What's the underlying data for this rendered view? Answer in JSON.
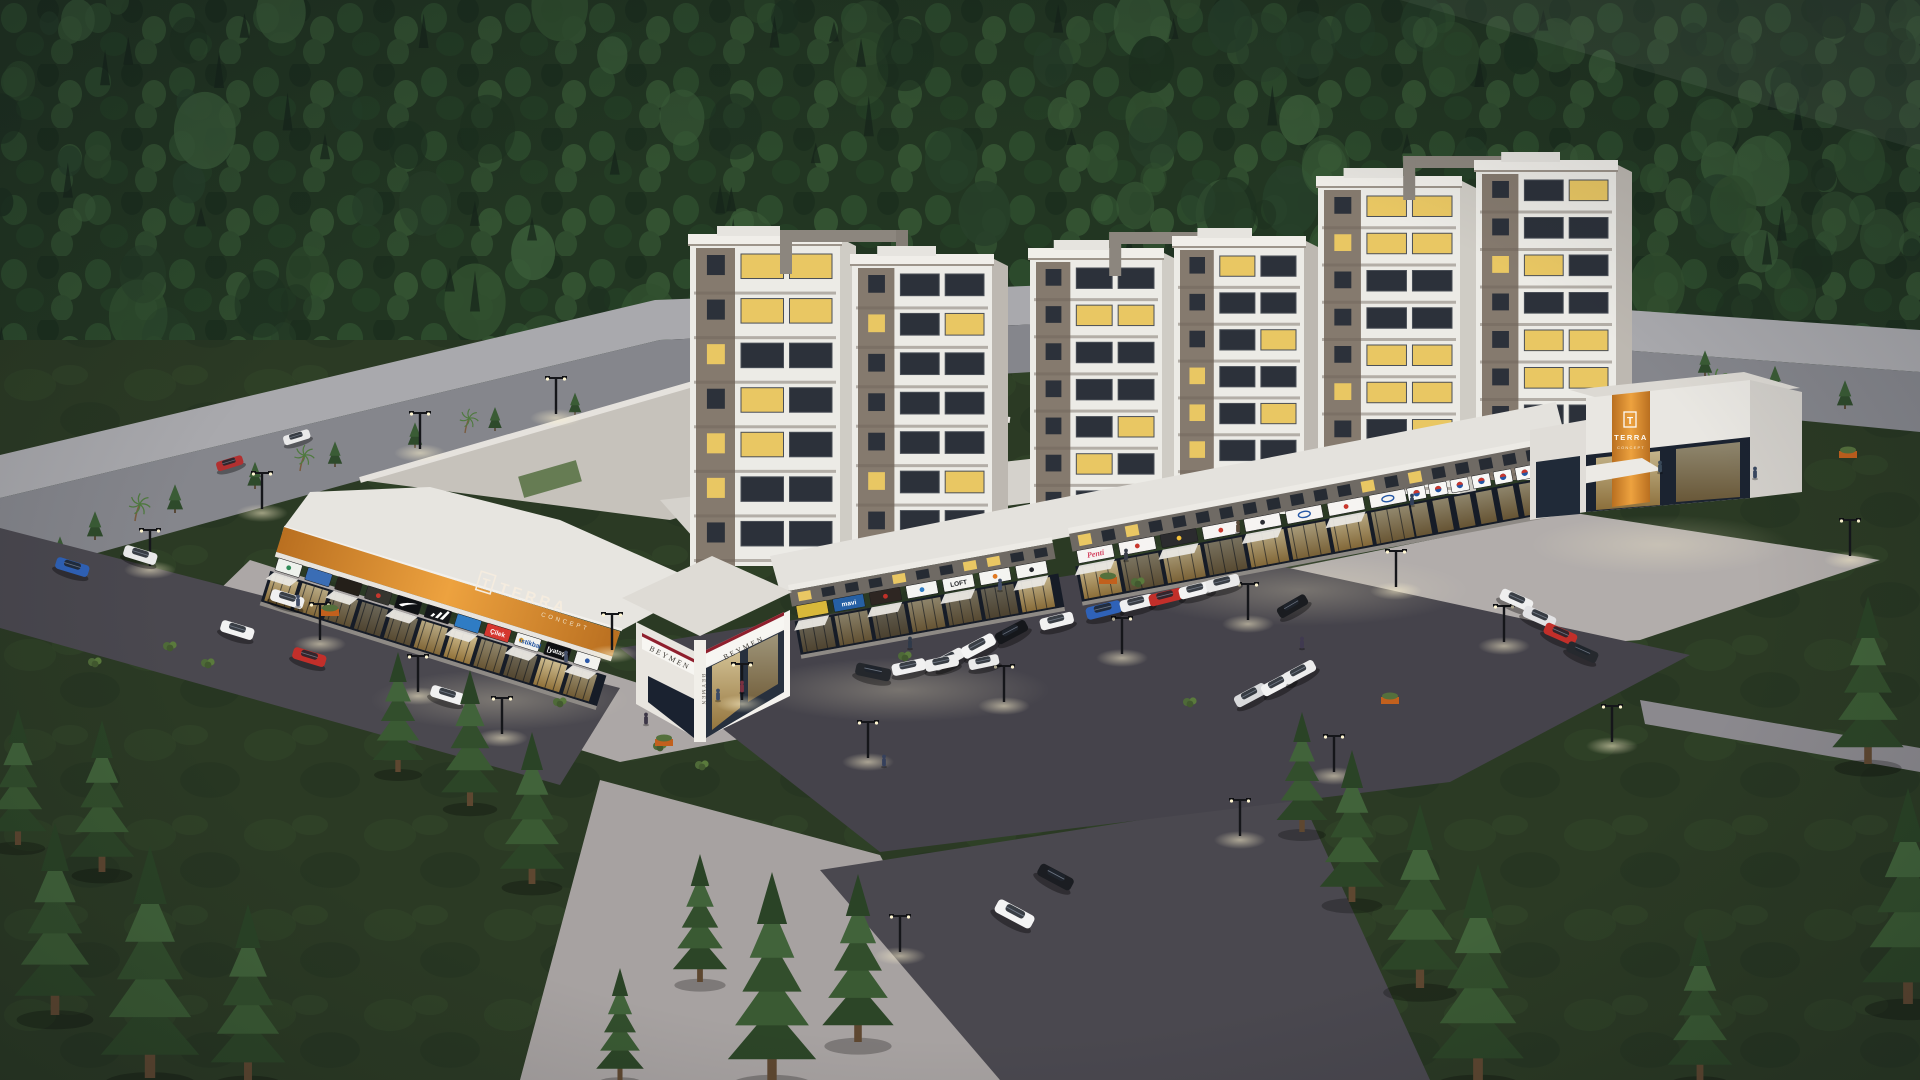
{
  "meta": {
    "type": "3d-architectural-render",
    "setting": "Aerial dusk rendering of a mixed-use residential complex with ground-floor retail, central parking lot, surrounded by dense pine forest"
  },
  "branding": {
    "monogram": "T",
    "name": "TERRA",
    "sub": "CONCEPT"
  },
  "corner": {
    "brand": "BEYMEN",
    "bg": "#f7f6f2",
    "text_color": "#3a3731",
    "accent": "#8f1f2d"
  },
  "palette": {
    "forest": "#223622",
    "lawn": "#2b3a24",
    "asphalt": "#45434b",
    "plaza": "#b2adab",
    "fascia_orange": "#d98f2e",
    "tower_wall": "#ecebe6",
    "tower_accent": "#7d7268",
    "window_lit": "#e9c763",
    "glass_dark": "#141b26",
    "roof_white": "#e7e5e0",
    "back_road": "#85868c"
  },
  "left_wing": {
    "signs": [
      {
        "label": "",
        "bg": "#eef1ec",
        "fg": "#2e8b57",
        "icon": "dot",
        "iconColor": "#2e8b57"
      },
      {
        "label": "",
        "bg": "#3a6db5",
        "fg": "#ffffff"
      },
      {
        "label": "",
        "bg": "#241f19",
        "fg": "#d9b13c"
      },
      {
        "label": "",
        "bg": "#35352f",
        "fg": "#ffffff",
        "icon": "dot",
        "iconColor": "#c8372d"
      },
      {
        "icon": "nike",
        "bg": "#0f1114"
      },
      {
        "icon": "adidas",
        "bg": "#14161a"
      },
      {
        "label": "",
        "bg": "#2f7cc4",
        "fg": "#ffffff"
      },
      {
        "label": "Çilek",
        "bg": "#d5372f",
        "fg": "#ffffff"
      },
      {
        "label": "istikbal",
        "bg": "#f2f2ef",
        "fg": "#1e4f9c",
        "icon": "dot",
        "iconColor": "#f0a71f"
      },
      {
        "label": "[yataş]",
        "bg": "#0e0f12",
        "fg": "#ffffff"
      },
      {
        "label": "",
        "bg": "#f2f2ef",
        "fg": "#2a57a8",
        "icon": "dot",
        "iconColor": "#2a57a8"
      }
    ]
  },
  "middle_wing": {
    "signs": [
      {
        "label": "",
        "bg": "#d9b83a",
        "fg": "#24221c"
      },
      {
        "label": "mavi",
        "bg": "#2660a4",
        "fg": "#ffffff"
      },
      {
        "label": "",
        "bg": "#2e2622",
        "fg": "#ffffff",
        "icon": "dot",
        "iconColor": "#c03028"
      },
      {
        "label": "",
        "bg": "#f4f4f1",
        "fg": "#2f7cc4",
        "icon": "dot",
        "iconColor": "#2f7cc4"
      },
      {
        "label": "LOFT",
        "bg": "#f4f4f1",
        "fg": "#1a1c20"
      },
      {
        "label": "",
        "bg": "#f4f4f1",
        "fg": "#e07820",
        "icon": "dot",
        "iconColor": "#e07820"
      },
      {
        "label": "",
        "bg": "#f4f4f1",
        "fg": "#23252b",
        "icon": "dot",
        "iconColor": "#23252b"
      }
    ]
  },
  "right_wing": {
    "signs": [
      {
        "label": "Penti",
        "bg": "#f6f4f2",
        "fg": "#d3425f",
        "style": "script"
      },
      {
        "label": "",
        "bg": "#f6f4f2",
        "fg": "#33353b",
        "icon": "dot",
        "iconColor": "#c8372d"
      },
      {
        "label": "",
        "bg": "#2b2b2e",
        "fg": "#f6c23a",
        "icon": "dot",
        "iconColor": "#f6c23a"
      },
      {
        "label": "",
        "bg": "#f6f4f2",
        "fg": "#c8372d",
        "icon": "dot",
        "iconColor": "#c8372d"
      },
      {
        "label": "",
        "bg": "#f6f4f2",
        "fg": "#2b2d33",
        "icon": "dot",
        "iconColor": "#2b2d33"
      },
      {
        "label": "",
        "bg": "#f6f4f2",
        "icon": "oval",
        "iconColor": "#2456a4"
      },
      {
        "label": "",
        "bg": "#f6f4f2",
        "fg": "#c8372d",
        "icon": "dot",
        "iconColor": "#c8372d"
      },
      {
        "label": "",
        "bg": "#f6f4f2",
        "icon": "oval",
        "iconColor": "#2456a4"
      }
    ],
    "market": {
      "count": 7,
      "bg": "#f8f8f6",
      "logo": "#2456a4",
      "accent": "#c8372d"
    }
  },
  "towers": [
    {
      "x": 690,
      "top": 238,
      "base": 566,
      "w": 150,
      "floors": 7
    },
    {
      "x": 852,
      "top": 258,
      "base": 550,
      "w": 140,
      "floors": 7
    },
    {
      "x": 1030,
      "top": 252,
      "base": 528,
      "w": 132,
      "floors": 7
    },
    {
      "x": 1174,
      "top": 240,
      "base": 514,
      "w": 130,
      "floors": 7
    },
    {
      "x": 1318,
      "top": 180,
      "base": 494,
      "w": 142,
      "floors": 8
    },
    {
      "x": 1476,
      "top": 164,
      "base": 480,
      "w": 140,
      "floors": 8
    }
  ],
  "cars": [
    [
      230,
      464,
      -17,
      "#b23030",
      0.8
    ],
    [
      297,
      438,
      -17,
      "#e9e9e9",
      0.8
    ],
    [
      72,
      568,
      17,
      "#2f62b8",
      1
    ],
    [
      140,
      556,
      17,
      "#ebebeb",
      1
    ],
    [
      287,
      600,
      17,
      "#f0f0f0",
      1
    ],
    [
      237,
      631,
      17,
      "#f2f2f2",
      1
    ],
    [
      309,
      658,
      17,
      "#c22f2a",
      1
    ],
    [
      447,
      696,
      17,
      "#f1f1f1",
      1
    ],
    [
      949,
      660,
      -28,
      "#ededed",
      0.95
    ],
    [
      979,
      647,
      -28,
      "#f4f4f4",
      1.05
    ],
    [
      1012,
      633,
      -28,
      "#15171b",
      1
    ],
    [
      1057,
      622,
      -14,
      "#f1f1f1",
      1
    ],
    [
      1104,
      611,
      -14,
      "#2f62b8",
      1.05
    ],
    [
      1137,
      604,
      -14,
      "#efefef",
      1
    ],
    [
      1166,
      598,
      -14,
      "#c22f2a",
      1
    ],
    [
      1196,
      591,
      -14,
      "#f3f3f3",
      1
    ],
    [
      1223,
      584,
      -14,
      "#e9e9e9",
      1
    ],
    [
      1293,
      607,
      -30,
      "#1a1c20",
      0.95
    ],
    [
      1516,
      601,
      24,
      "#efefef",
      1
    ],
    [
      1539,
      618,
      24,
      "#e2e2e4",
      1
    ],
    [
      1560,
      635,
      24,
      "#c22f2a",
      1
    ],
    [
      1582,
      653,
      24,
      "#26292e",
      0.95
    ],
    [
      1251,
      696,
      -28,
      "#d9dadc",
      1
    ],
    [
      1278,
      685,
      -28,
      "#f2f2f2",
      1
    ],
    [
      1300,
      673,
      -28,
      "#ededed",
      1
    ],
    [
      873,
      673,
      12,
      "#24272c",
      1.05
    ],
    [
      909,
      668,
      -12,
      "#f1f1f1",
      1
    ],
    [
      942,
      664,
      -12,
      "#eeeeee",
      1
    ],
    [
      984,
      663,
      -12,
      "#eaeaea",
      0.9
    ],
    [
      1055,
      878,
      28,
      "#1b1d22",
      1.1
    ],
    [
      1014,
      915,
      28,
      "#f4f4f4",
      1.2
    ]
  ],
  "streetlights": [
    [
      150,
      566
    ],
    [
      262,
      509
    ],
    [
      420,
      449
    ],
    [
      556,
      414
    ],
    [
      320,
      640
    ],
    [
      418,
      692
    ],
    [
      502,
      734
    ],
    [
      612,
      650
    ],
    [
      742,
      700
    ],
    [
      868,
      758
    ],
    [
      1004,
      702
    ],
    [
      1122,
      654
    ],
    [
      1248,
      620
    ],
    [
      1396,
      587
    ],
    [
      1504,
      642
    ],
    [
      1334,
      772
    ],
    [
      1240,
      836
    ],
    [
      900,
      952
    ],
    [
      1612,
      742
    ],
    [
      1850,
      556
    ]
  ],
  "people": [
    [
      718,
      700,
      "#3a4a66"
    ],
    [
      742,
      692,
      "#7a3040"
    ],
    [
      910,
      648,
      "#2f3a4a"
    ],
    [
      1000,
      590,
      "#44506b"
    ],
    [
      1126,
      560,
      "#3a3f4a"
    ],
    [
      1238,
      532,
      "#5a4a3a"
    ],
    [
      1412,
      505,
      "#32405a"
    ],
    [
      1660,
      472,
      "#3a4a5a"
    ],
    [
      566,
      662,
      "#46506a"
    ],
    [
      646,
      724,
      "#3c3646"
    ],
    [
      884,
      766,
      "#35405c"
    ],
    [
      1302,
      648,
      "#403a50"
    ],
    [
      1755,
      478,
      "#39475f"
    ],
    [
      298,
      606,
      "#424e68"
    ]
  ],
  "vegetation": {
    "pines": [
      [
        55,
        1015,
        2.4
      ],
      [
        150,
        1078,
        2.9
      ],
      [
        248,
        1080,
        2.2
      ],
      [
        18,
        845,
        1.7
      ],
      [
        102,
        872,
        1.9
      ],
      [
        398,
        772,
        1.5
      ],
      [
        470,
        806,
        1.7
      ],
      [
        532,
        884,
        1.9
      ],
      [
        620,
        1080,
        1.4
      ],
      [
        772,
        1080,
        2.6
      ],
      [
        858,
        1042,
        2.1
      ],
      [
        700,
        982,
        1.6
      ],
      [
        1352,
        902,
        1.9
      ],
      [
        1420,
        988,
        2.3
      ],
      [
        1302,
        832,
        1.5
      ],
      [
        1478,
        1080,
        2.7
      ],
      [
        1868,
        764,
        2.1
      ],
      [
        1908,
        1004,
        2.7
      ],
      [
        1700,
        1080,
        1.9
      ]
    ],
    "conifers": [
      [
        95,
        540,
        0.9
      ],
      [
        175,
        513,
        0.9
      ],
      [
        255,
        489,
        0.85
      ],
      [
        335,
        467,
        0.8
      ],
      [
        415,
        448,
        0.8
      ],
      [
        495,
        431,
        0.75
      ],
      [
        575,
        415,
        0.7
      ],
      [
        1705,
        376,
        0.8
      ],
      [
        1775,
        393,
        0.85
      ],
      [
        1845,
        409,
        0.9
      ],
      [
        60,
        562,
        0.8
      ]
    ],
    "palms": [
      [
        135,
        521,
        0.8
      ],
      [
        300,
        471,
        0.75
      ],
      [
        465,
        433,
        0.7
      ],
      [
        596,
        470,
        0.8
      ],
      [
        624,
        460,
        0.85
      ],
      [
        654,
        452,
        0.8
      ],
      [
        610,
        486,
        0.7
      ],
      [
        1712,
        400,
        0.9
      ]
    ],
    "bushes": [
      [
        170,
        646
      ],
      [
        208,
        663
      ],
      [
        95,
        662
      ],
      [
        660,
        746
      ],
      [
        702,
        765
      ],
      [
        560,
        702
      ],
      [
        905,
        656
      ],
      [
        1190,
        702
      ],
      [
        1138,
        582
      ]
    ],
    "planters": [
      [
        1108,
        580
      ],
      [
        664,
        742
      ],
      [
        330,
        612
      ],
      [
        1848,
        454
      ],
      [
        1390,
        700
      ]
    ]
  }
}
